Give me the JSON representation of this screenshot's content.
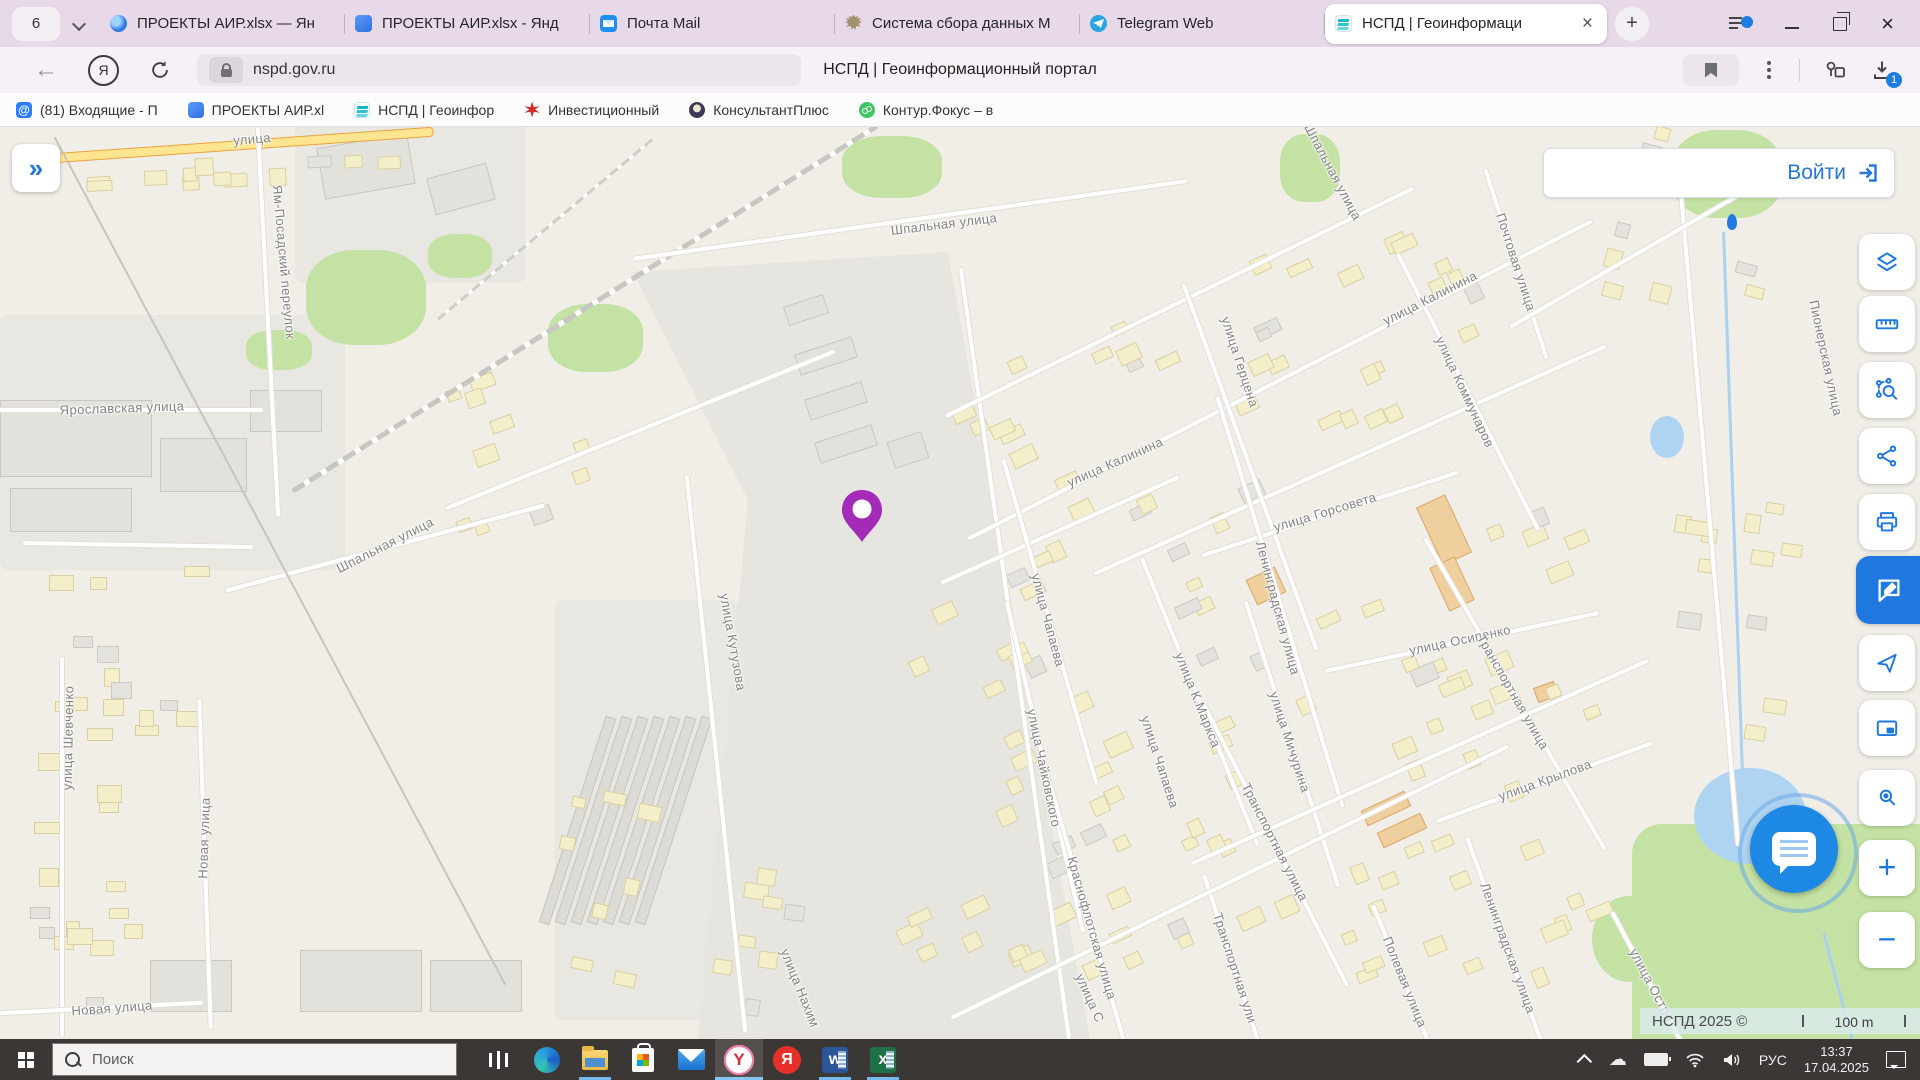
{
  "browser": {
    "tab_counter": "6",
    "new_tab_label": "+",
    "tabs": [
      {
        "title": "ПРОЕКТЫ АИР.xlsx — Ян",
        "icon": "yandex-browser",
        "active": false
      },
      {
        "title": "ПРОЕКТЫ АИР.xlsx - Янд",
        "icon": "cube",
        "active": false
      },
      {
        "title": "Почта Mail",
        "icon": "mail-envelope",
        "active": false
      },
      {
        "title": "Система сбора данных М",
        "icon": "eagle-emblem",
        "active": false
      },
      {
        "title": "Telegram Web",
        "icon": "telegram",
        "active": false
      },
      {
        "title": "НСПД | Геоинформаци",
        "icon": "nspd-layers",
        "active": true
      }
    ],
    "address": {
      "url": "nspd.gov.ru",
      "page_title": "НСПД | Геоинформационный портал",
      "download_badge": "1"
    },
    "bookmarks": [
      {
        "label": "(81) Входящие - П",
        "icon": "mailru-at"
      },
      {
        "label": "ПРОЕКТЫ АИР.xl",
        "icon": "cube"
      },
      {
        "label": "НСПД | Геоинфор",
        "icon": "nspd-layers"
      },
      {
        "label": "Инвестиционный",
        "icon": "red-star"
      },
      {
        "label": "КонсультантПлюс",
        "icon": "consultant"
      },
      {
        "label": "Контур.Фокус – в",
        "icon": "kontur"
      }
    ]
  },
  "page": {
    "login_label": "Войти",
    "attribution": "НСПД 2025 ©",
    "scale_label": "100 m",
    "tools": [
      {
        "name": "layers",
        "y": 234
      },
      {
        "name": "ruler",
        "y": 296
      },
      {
        "name": "area-search",
        "y": 362
      },
      {
        "name": "share",
        "y": 428
      },
      {
        "name": "print",
        "y": 494
      },
      {
        "name": "feedback",
        "y": 556,
        "active": true
      },
      {
        "name": "locate",
        "y": 635
      },
      {
        "name": "mini-map",
        "y": 700
      },
      {
        "name": "place-search",
        "y": 770
      },
      {
        "name": "zoom-in",
        "y": 840
      },
      {
        "name": "zoom-out",
        "y": 912
      }
    ]
  },
  "map": {
    "pin": {
      "x": 862,
      "y": 540,
      "color": "#A32BB8"
    },
    "mini_marker": {
      "x": 1732,
      "y": 222
    },
    "labels": [
      {
        "t": "улица",
        "x": 252,
        "y": 139,
        "r": -5
      },
      {
        "t": "Ям-Посадский переулок",
        "x": 284,
        "y": 262,
        "r": 85
      },
      {
        "t": "Ярославская улица",
        "x": 122,
        "y": 408,
        "r": -2
      },
      {
        "t": "Шпальная улица",
        "x": 944,
        "y": 224,
        "r": -7
      },
      {
        "t": "Шпальная улица",
        "x": 1333,
        "y": 172,
        "r": 62
      },
      {
        "t": "Шпальная улица",
        "x": 385,
        "y": 545,
        "r": -27
      },
      {
        "t": "Почтовая улица",
        "x": 1516,
        "y": 262,
        "r": 72
      },
      {
        "t": "улица Калинина",
        "x": 1430,
        "y": 298,
        "r": -27
      },
      {
        "t": "улица Коммунаров",
        "x": 1465,
        "y": 392,
        "r": 65
      },
      {
        "t": "Пионерская улица",
        "x": 1826,
        "y": 358,
        "r": 78
      },
      {
        "t": "улица Герцена",
        "x": 1240,
        "y": 362,
        "r": 72
      },
      {
        "t": "улица Калинина",
        "x": 1115,
        "y": 462,
        "r": -24
      },
      {
        "t": "улица Горсовета",
        "x": 1325,
        "y": 512,
        "r": -17
      },
      {
        "t": "Ленинградская улица",
        "x": 1278,
        "y": 608,
        "r": 75
      },
      {
        "t": "улица Осипенко",
        "x": 1460,
        "y": 640,
        "r": -12
      },
      {
        "t": "улица Кутузова",
        "x": 733,
        "y": 642,
        "r": 80
      },
      {
        "t": "улица Чапаева",
        "x": 1048,
        "y": 620,
        "r": 75
      },
      {
        "t": "улица К.Маркса",
        "x": 1198,
        "y": 700,
        "r": 68
      },
      {
        "t": "улица Мичурина",
        "x": 1290,
        "y": 742,
        "r": 72
      },
      {
        "t": "улица Чайковского",
        "x": 1044,
        "y": 768,
        "r": 78
      },
      {
        "t": "Транспортная улица",
        "x": 1513,
        "y": 692,
        "r": 60
      },
      {
        "t": "улица Чапаева",
        "x": 1160,
        "y": 762,
        "r": 72
      },
      {
        "t": "улица Крылова",
        "x": 1545,
        "y": 780,
        "r": -20
      },
      {
        "t": "Краснофлотская улица",
        "x": 1092,
        "y": 928,
        "r": 74
      },
      {
        "t": "Транспортная улица",
        "x": 1275,
        "y": 842,
        "r": 63
      },
      {
        "t": "Транспортная ули",
        "x": 1235,
        "y": 968,
        "r": 72
      },
      {
        "t": "Полевая улица",
        "x": 1405,
        "y": 982,
        "r": 68
      },
      {
        "t": "Ленинградская улица",
        "x": 1508,
        "y": 948,
        "r": 70
      },
      {
        "t": "улица Остро",
        "x": 1652,
        "y": 985,
        "r": 62
      },
      {
        "t": "улица Шевченко",
        "x": 68,
        "y": 738,
        "r": -89
      },
      {
        "t": "Новая улица",
        "x": 204,
        "y": 838,
        "r": -88
      },
      {
        "t": "Новая улица",
        "x": 112,
        "y": 1008,
        "r": -4
      },
      {
        "t": "улица Нахим",
        "x": 800,
        "y": 988,
        "r": 68
      },
      {
        "t": "улица С",
        "x": 1090,
        "y": 998,
        "r": 66
      }
    ],
    "zones": [
      {
        "x": 0,
        "y": 315,
        "w": 345,
        "h": 255,
        "c": "i"
      },
      {
        "x": 295,
        "y": 118,
        "w": 230,
        "h": 165,
        "c": "i"
      },
      {
        "x": 555,
        "y": 600,
        "w": 185,
        "h": 420,
        "c": "i"
      },
      {
        "x": 306,
        "y": 250,
        "w": 120,
        "h": 95,
        "c": "g",
        "rad": "40%"
      },
      {
        "x": 246,
        "y": 330,
        "w": 66,
        "h": 40,
        "c": "g",
        "rad": "40%"
      },
      {
        "x": 428,
        "y": 234,
        "w": 64,
        "h": 44,
        "c": "g",
        "rad": "40%"
      },
      {
        "x": 548,
        "y": 304,
        "w": 95,
        "h": 68,
        "c": "g",
        "rad": "40%"
      },
      {
        "x": 842,
        "y": 136,
        "w": 100,
        "h": 62,
        "c": "g",
        "rad": "40%"
      },
      {
        "x": 1280,
        "y": 134,
        "w": 60,
        "h": 68,
        "c": "g",
        "rad": "40%"
      },
      {
        "x": 1672,
        "y": 130,
        "w": 110,
        "h": 88,
        "c": "g",
        "rad": "40%"
      },
      {
        "x": 1632,
        "y": 824,
        "w": 288,
        "h": 216,
        "c": "g",
        "rad": "30px 0 0 0"
      },
      {
        "x": 1592,
        "y": 896,
        "w": 74,
        "h": 86,
        "c": "g",
        "rad": "50%"
      },
      {
        "x": 1650,
        "y": 416,
        "w": 34,
        "h": 42,
        "c": "w",
        "rad": "50%"
      },
      {
        "x": 1694,
        "y": 768,
        "w": 112,
        "h": 96,
        "c": "w",
        "rad": "50%"
      }
    ],
    "roads": [
      {
        "x": 243,
        "y": 141,
        "l": 380,
        "r": -4,
        "k": "m"
      },
      {
        "x": 268,
        "y": 320,
        "l": 390,
        "r": 87,
        "k": "n"
      },
      {
        "x": 130,
        "y": 408,
        "l": 265,
        "r": 0,
        "k": "n"
      },
      {
        "x": 138,
        "y": 543,
        "l": 230,
        "r": 1,
        "k": "n"
      },
      {
        "x": 385,
        "y": 546,
        "l": 330,
        "r": -15,
        "k": "n"
      },
      {
        "x": 62,
        "y": 845,
        "l": 380,
        "r": 90,
        "k": "n"
      },
      {
        "x": 205,
        "y": 862,
        "l": 330,
        "r": 88,
        "k": "n"
      },
      {
        "x": 100,
        "y": 1006,
        "l": 205,
        "r": -3,
        "k": "n"
      },
      {
        "x": 280,
        "y": 560,
        "l": 960,
        "r": 62,
        "k": "t"
      },
      {
        "x": 585,
        "y": 306,
        "l": 690,
        "r": -32,
        "k": "rail"
      },
      {
        "x": 545,
        "y": 228,
        "l": 280,
        "r": -40,
        "k": "railt"
      },
      {
        "x": 640,
        "y": 428,
        "l": 420,
        "r": -22,
        "k": "n"
      },
      {
        "x": 910,
        "y": 218,
        "l": 560,
        "r": -8,
        "k": "n"
      },
      {
        "x": 1015,
        "y": 652,
        "l": 780,
        "r": 82,
        "k": "n"
      },
      {
        "x": 716,
        "y": 752,
        "l": 560,
        "r": 84,
        "k": "n"
      },
      {
        "x": 1280,
        "y": 378,
        "l": 700,
        "r": -27,
        "k": "n"
      },
      {
        "x": 1180,
        "y": 300,
        "l": 520,
        "r": -26,
        "k": "n"
      },
      {
        "x": 1060,
        "y": 528,
        "l": 260,
        "r": -24,
        "k": "n"
      },
      {
        "x": 1350,
        "y": 458,
        "l": 560,
        "r": -24,
        "k": "n"
      },
      {
        "x": 1250,
        "y": 465,
        "l": 390,
        "r": 70,
        "k": "n"
      },
      {
        "x": 1516,
        "y": 262,
        "l": 200,
        "r": 72,
        "k": "n"
      },
      {
        "x": 1468,
        "y": 390,
        "l": 310,
        "r": 63,
        "k": "n"
      },
      {
        "x": 1330,
        "y": 512,
        "l": 270,
        "r": -18,
        "k": "n"
      },
      {
        "x": 1462,
        "y": 640,
        "l": 280,
        "r": -12,
        "k": "n"
      },
      {
        "x": 1280,
        "y": 600,
        "l": 430,
        "r": 73,
        "k": "n"
      },
      {
        "x": 1050,
        "y": 620,
        "l": 340,
        "r": 74,
        "k": "n"
      },
      {
        "x": 1200,
        "y": 700,
        "l": 310,
        "r": 68,
        "k": "n"
      },
      {
        "x": 1292,
        "y": 742,
        "l": 300,
        "r": 72,
        "k": "n"
      },
      {
        "x": 1045,
        "y": 765,
        "l": 340,
        "r": 77,
        "k": "n"
      },
      {
        "x": 1515,
        "y": 692,
        "l": 360,
        "r": 60,
        "k": "n"
      },
      {
        "x": 1545,
        "y": 780,
        "l": 230,
        "r": -20,
        "k": "n"
      },
      {
        "x": 1092,
        "y": 928,
        "l": 300,
        "r": 74,
        "k": "n"
      },
      {
        "x": 1275,
        "y": 842,
        "l": 320,
        "r": 63,
        "k": "n"
      },
      {
        "x": 1235,
        "y": 968,
        "l": 200,
        "r": 72,
        "k": "n"
      },
      {
        "x": 1405,
        "y": 982,
        "l": 170,
        "r": 68,
        "k": "n"
      },
      {
        "x": 1508,
        "y": 948,
        "l": 240,
        "r": 70,
        "k": "n"
      },
      {
        "x": 1652,
        "y": 985,
        "l": 170,
        "r": 62,
        "k": "n"
      },
      {
        "x": 1230,
        "y": 880,
        "l": 620,
        "r": -26,
        "k": "n"
      },
      {
        "x": 1420,
        "y": 760,
        "l": 500,
        "r": -24,
        "k": "n"
      },
      {
        "x": 1708,
        "y": 500,
        "l": 690,
        "r": 85,
        "k": "n"
      },
      {
        "x": 1640,
        "y": 250,
        "l": 300,
        "r": -30,
        "k": "n"
      },
      {
        "x": 1733,
        "y": 500,
        "l": 540,
        "r": 88,
        "k": "stream"
      },
      {
        "x": 1838,
        "y": 985,
        "l": 110,
        "r": 75,
        "k": "stream"
      }
    ],
    "buildings": [
      {
        "x": 0,
        "y": 400,
        "w": 150,
        "h": 75,
        "c": "b"
      },
      {
        "x": 10,
        "y": 488,
        "w": 120,
        "h": 42,
        "c": "b"
      },
      {
        "x": 160,
        "y": 438,
        "w": 85,
        "h": 52,
        "c": "b"
      },
      {
        "x": 250,
        "y": 390,
        "w": 70,
        "h": 40,
        "c": "b"
      },
      {
        "x": 320,
        "y": 140,
        "w": 90,
        "h": 50,
        "r": -10,
        "c": "b"
      },
      {
        "x": 430,
        "y": 170,
        "w": 60,
        "h": 36,
        "r": -15,
        "c": "b"
      },
      {
        "x": 300,
        "y": 950,
        "w": 120,
        "h": 60,
        "c": "b"
      },
      {
        "x": 150,
        "y": 960,
        "w": 80,
        "h": 50,
        "c": "b"
      },
      {
        "x": 430,
        "y": 960,
        "w": 90,
        "h": 50,
        "c": "b"
      },
      {
        "x": 785,
        "y": 300,
        "w": 40,
        "h": 18,
        "r": -18,
        "c": "b"
      },
      {
        "x": 796,
        "y": 345,
        "w": 58,
        "h": 20,
        "r": -18,
        "c": "b"
      },
      {
        "x": 806,
        "y": 390,
        "w": 58,
        "h": 20,
        "r": -18,
        "c": "b"
      },
      {
        "x": 816,
        "y": 433,
        "w": 58,
        "h": 20,
        "r": -18,
        "c": "b"
      },
      {
        "x": 890,
        "y": 436,
        "w": 34,
        "h": 26,
        "r": -18,
        "c": "b"
      },
      {
        "x": 1428,
        "y": 498,
        "w": 30,
        "h": 62,
        "r": -25,
        "c": "o"
      },
      {
        "x": 1438,
        "y": 560,
        "w": 26,
        "h": 46,
        "r": -25,
        "c": "o"
      },
      {
        "x": 1250,
        "y": 572,
        "w": 30,
        "h": 26,
        "r": -25,
        "c": "o"
      },
      {
        "x": 1362,
        "y": 800,
        "w": 46,
        "h": 15,
        "r": -25,
        "c": "o"
      },
      {
        "x": 1378,
        "y": 822,
        "w": 46,
        "h": 15,
        "r": -25,
        "c": "o"
      },
      {
        "x": 1535,
        "y": 684,
        "w": 20,
        "h": 14,
        "r": -20,
        "c": "o"
      }
    ],
    "stripes": {
      "x0": 572,
      "y": 712,
      "n": 7,
      "dx": 16,
      "w": 9,
      "h": 215,
      "r": 18
    },
    "house_regions": [
      {
        "x": 950,
        "y": 260,
        "w": 600,
        "h": 260,
        "r": -25,
        "n": 40
      },
      {
        "x": 930,
        "y": 520,
        "w": 420,
        "h": 320,
        "r": -25,
        "n": 30
      },
      {
        "x": 1360,
        "y": 520,
        "w": 290,
        "h": 300,
        "r": -22,
        "n": 22
      },
      {
        "x": 860,
        "y": 840,
        "w": 440,
        "h": 180,
        "r": -25,
        "n": 24
      },
      {
        "x": 1300,
        "y": 820,
        "w": 350,
        "h": 190,
        "r": -22,
        "n": 16
      },
      {
        "x": 25,
        "y": 540,
        "w": 205,
        "h": 480,
        "r": 0,
        "n": 30
      },
      {
        "x": 60,
        "y": 152,
        "w": 360,
        "h": 40,
        "r": -3,
        "n": 12
      },
      {
        "x": 430,
        "y": 340,
        "w": 230,
        "h": 220,
        "r": -20,
        "n": 10
      },
      {
        "x": 1600,
        "y": 140,
        "w": 200,
        "h": 190,
        "r": 15,
        "n": 12
      },
      {
        "x": 1645,
        "y": 430,
        "w": 160,
        "h": 350,
        "r": 8,
        "n": 12
      },
      {
        "x": 540,
        "y": 750,
        "w": 120,
        "h": 260,
        "r": 12,
        "n": 8
      },
      {
        "x": 700,
        "y": 850,
        "w": 130,
        "h": 170,
        "r": 8,
        "n": 8
      }
    ]
  },
  "taskbar": {
    "search_placeholder": "Поиск",
    "language": "РУС",
    "time": "13:37",
    "date": "17.04.2025"
  }
}
